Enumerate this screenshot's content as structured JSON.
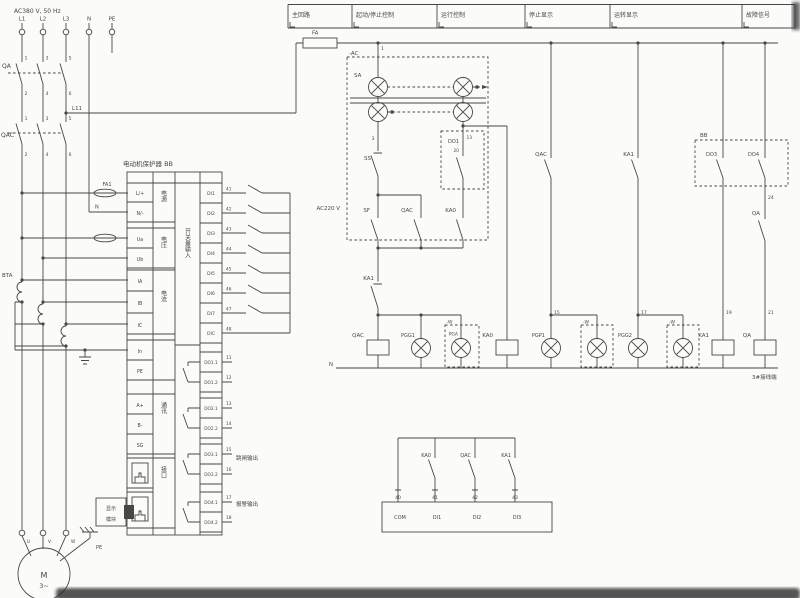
{
  "colors": {
    "ink": "#474747",
    "background": "#fbfbf9",
    "smear": "#2e2e2e"
  },
  "header": {
    "boxes": [
      {
        "label": "主回路"
      },
      {
        "label": "起动/停止控制"
      },
      {
        "label": "运行控制"
      },
      {
        "label": "停止显示"
      },
      {
        "label": "运转显示"
      },
      {
        "label": "故障信号"
      }
    ]
  },
  "block": {
    "title": "电动机保护器 BB"
  },
  "texts": [
    {
      "name": "supply-label",
      "t": "AC380 V, 50 Hz",
      "x": 14,
      "y": 13,
      "s": 6
    },
    {
      "name": "phase-l1-label",
      "t": "L1",
      "x": 22,
      "y": 20.5,
      "s": 5.5,
      "a": "m"
    },
    {
      "name": "phase-l2-label",
      "t": "L2",
      "x": 43,
      "y": 20.5,
      "s": 5.5,
      "a": "m"
    },
    {
      "name": "phase-l3-label",
      "t": "L3",
      "x": 66,
      "y": 20.5,
      "s": 5.5,
      "a": "m"
    },
    {
      "name": "neutral-label",
      "t": "N",
      "x": 89,
      "y": 20.5,
      "s": 5.5,
      "a": "m"
    },
    {
      "name": "pe-label",
      "t": "PE",
      "x": 112,
      "y": 20.5,
      "s": 5.5,
      "a": "m"
    },
    {
      "name": "breaker-label",
      "t": "QA",
      "x": 2,
      "y": 68,
      "s": 6
    },
    {
      "name": "qa-t1",
      "t": "1",
      "x": 26,
      "y": 59.5,
      "s": 4.5,
      "a": "m"
    },
    {
      "name": "qa-t3",
      "t": "3",
      "x": 47,
      "y": 59.5,
      "s": 4.5,
      "a": "m"
    },
    {
      "name": "qa-t5",
      "t": "5",
      "x": 70,
      "y": 59.5,
      "s": 4.5,
      "a": "m"
    },
    {
      "name": "qa-t2",
      "t": "2",
      "x": 26,
      "y": 95,
      "s": 4.5,
      "a": "m"
    },
    {
      "name": "qa-t4",
      "t": "4",
      "x": 47,
      "y": 95,
      "s": 4.5,
      "a": "m"
    },
    {
      "name": "qa-t6",
      "t": "6",
      "x": 70,
      "y": 95,
      "s": 4.5,
      "a": "m"
    },
    {
      "name": "contactor-label",
      "t": "QAC",
      "x": 1,
      "y": 137,
      "s": 6
    },
    {
      "name": "qac-t1",
      "t": "1",
      "x": 26,
      "y": 120,
      "s": 4.5,
      "a": "m"
    },
    {
      "name": "qac-t3",
      "t": "3",
      "x": 47,
      "y": 120,
      "s": 4.5,
      "a": "m"
    },
    {
      "name": "qac-t5",
      "t": "5",
      "x": 70,
      "y": 120,
      "s": 4.5,
      "a": "m"
    },
    {
      "name": "qac-t2",
      "t": "2",
      "x": 26,
      "y": 156,
      "s": 4.5,
      "a": "m"
    },
    {
      "name": "qac-t4",
      "t": "4",
      "x": 47,
      "y": 156,
      "s": 4.5,
      "a": "m"
    },
    {
      "name": "qac-t6",
      "t": "6",
      "x": 70,
      "y": 156,
      "s": 4.5,
      "a": "m"
    },
    {
      "name": "l11-label",
      "t": "L11",
      "x": 72,
      "y": 110,
      "s": 5.5
    },
    {
      "name": "fa-fuse-label",
      "t": "FA",
      "x": 312,
      "y": 34.5,
      "s": 5.5
    },
    {
      "name": "fa1-fuse-label",
      "t": "FA1",
      "x": 107,
      "y": 186,
      "s": 5,
      "a": "m"
    },
    {
      "name": "n-wire-label",
      "t": "N",
      "x": 95,
      "y": 208.5,
      "s": 5
    },
    {
      "name": "ct-label",
      "t": "BTA",
      "x": 2,
      "y": 277,
      "s": 5.5
    },
    {
      "name": "cell-l",
      "t": "L/+",
      "x": 140,
      "y": 195,
      "s": 4.8,
      "a": "m"
    },
    {
      "name": "cell-n",
      "t": "N/-",
      "x": 140,
      "y": 215,
      "s": 4.8,
      "a": "m"
    },
    {
      "name": "cell-ua",
      "t": "Ua",
      "x": 140,
      "y": 241,
      "s": 4.8,
      "a": "m"
    },
    {
      "name": "cell-ub",
      "t": "Ub",
      "x": 140,
      "y": 261,
      "s": 4.8,
      "a": "m"
    },
    {
      "name": "cell-ia",
      "t": "IA",
      "x": 140,
      "y": 283,
      "s": 4.8,
      "a": "m"
    },
    {
      "name": "cell-ib",
      "t": "IB",
      "x": 140,
      "y": 305,
      "s": 4.8,
      "a": "m"
    },
    {
      "name": "cell-ic",
      "t": "IC",
      "x": 140,
      "y": 327,
      "s": 4.8,
      "a": "m"
    },
    {
      "name": "cell-in",
      "t": "In",
      "x": 140,
      "y": 353,
      "s": 4.8,
      "a": "m"
    },
    {
      "name": "cell-pe",
      "t": "PE",
      "x": 140,
      "y": 373,
      "s": 4.8,
      "a": "m"
    },
    {
      "name": "cell-aplus",
      "t": "A+",
      "x": 140,
      "y": 407,
      "s": 4.8,
      "a": "m"
    },
    {
      "name": "cell-bminus",
      "t": "B-",
      "x": 140,
      "y": 427,
      "s": 4.8,
      "a": "m"
    },
    {
      "name": "cell-sg",
      "t": "SG",
      "x": 140,
      "y": 447,
      "s": 4.8,
      "a": "m"
    },
    {
      "name": "group-power",
      "t": "电源",
      "x": 163,
      "y": 190,
      "s": 6,
      "v": 1
    },
    {
      "name": "group-voltage",
      "t": "电压",
      "x": 163,
      "y": 236,
      "s": 6,
      "v": 1
    },
    {
      "name": "group-current",
      "t": "电流",
      "x": 163,
      "y": 290,
      "s": 6,
      "v": 1
    },
    {
      "name": "group-comm",
      "t": "通讯",
      "x": 163,
      "y": 402,
      "s": 6,
      "v": 1
    },
    {
      "name": "group-port",
      "t": "接口",
      "x": 163,
      "y": 466,
      "s": 6,
      "v": 1
    },
    {
      "name": "group-di",
      "t": "开关量输入",
      "x": 187,
      "y": 228,
      "s": 6,
      "v": 1
    },
    {
      "name": "cell-di1",
      "t": "DI1",
      "x": 211,
      "y": 195,
      "s": 4.6,
      "a": "m"
    },
    {
      "name": "cell-di2",
      "t": "DI2",
      "x": 211,
      "y": 215,
      "s": 4.6,
      "a": "m"
    },
    {
      "name": "cell-di3",
      "t": "DI3",
      "x": 211,
      "y": 235,
      "s": 4.6,
      "a": "m"
    },
    {
      "name": "cell-di4",
      "t": "DI4",
      "x": 211,
      "y": 255,
      "s": 4.6,
      "a": "m"
    },
    {
      "name": "cell-di5",
      "t": "DI5",
      "x": 211,
      "y": 275,
      "s": 4.6,
      "a": "m"
    },
    {
      "name": "cell-di6",
      "t": "DI6",
      "x": 211,
      "y": 295,
      "s": 4.6,
      "a": "m"
    },
    {
      "name": "cell-di7",
      "t": "DI7",
      "x": 211,
      "y": 315,
      "s": 4.6,
      "a": "m"
    },
    {
      "name": "cell-dic",
      "t": "DIC",
      "x": 211,
      "y": 335,
      "s": 4.6,
      "a": "m"
    },
    {
      "name": "di-t41",
      "t": "41",
      "x": 226,
      "y": 190.5,
      "s": 4.3
    },
    {
      "name": "di-t42",
      "t": "42",
      "x": 226,
      "y": 210.5,
      "s": 4.3
    },
    {
      "name": "di-t43",
      "t": "43",
      "x": 226,
      "y": 230.5,
      "s": 4.3
    },
    {
      "name": "di-t44",
      "t": "44",
      "x": 226,
      "y": 250.5,
      "s": 4.3
    },
    {
      "name": "di-t45",
      "t": "45",
      "x": 226,
      "y": 270.5,
      "s": 4.3
    },
    {
      "name": "di-t46",
      "t": "46",
      "x": 226,
      "y": 290.5,
      "s": 4.3
    },
    {
      "name": "di-t47",
      "t": "47",
      "x": 226,
      "y": 310.5,
      "s": 4.3
    },
    {
      "name": "di-t48",
      "t": "48",
      "x": 226,
      "y": 330.5,
      "s": 4.3
    },
    {
      "name": "cell-do11",
      "t": "DO1.1",
      "x": 211,
      "y": 364,
      "s": 4.3,
      "a": "m"
    },
    {
      "name": "cell-do12",
      "t": "DO1.2",
      "x": 211,
      "y": 384,
      "s": 4.3,
      "a": "m"
    },
    {
      "name": "cell-do21",
      "t": "DO2.1",
      "x": 211,
      "y": 410,
      "s": 4.3,
      "a": "m"
    },
    {
      "name": "cell-do22",
      "t": "DO2.2",
      "x": 211,
      "y": 430,
      "s": 4.3,
      "a": "m"
    },
    {
      "name": "cell-do31",
      "t": "DO3.1",
      "x": 211,
      "y": 456,
      "s": 4.3,
      "a": "m"
    },
    {
      "name": "cell-do32",
      "t": "DO3.2",
      "x": 211,
      "y": 476,
      "s": 4.3,
      "a": "m"
    },
    {
      "name": "cell-do41",
      "t": "DO4.1",
      "x": 211,
      "y": 504,
      "s": 4.3,
      "a": "m"
    },
    {
      "name": "cell-do42",
      "t": "DO4.2",
      "x": 211,
      "y": 524,
      "s": 4.3,
      "a": "m"
    },
    {
      "name": "do-t11",
      "t": "11",
      "x": 226,
      "y": 359,
      "s": 4.3
    },
    {
      "name": "do-t12",
      "t": "12",
      "x": 226,
      "y": 379,
      "s": 4.3
    },
    {
      "name": "do-t13",
      "t": "13",
      "x": 226,
      "y": 405,
      "s": 4.3
    },
    {
      "name": "do-t14",
      "t": "14",
      "x": 226,
      "y": 425,
      "s": 4.3
    },
    {
      "name": "do-t15",
      "t": "15",
      "x": 226,
      "y": 451,
      "s": 4.3
    },
    {
      "name": "do-t16",
      "t": "16",
      "x": 226,
      "y": 471,
      "s": 4.3
    },
    {
      "name": "do-t17",
      "t": "17",
      "x": 226,
      "y": 499,
      "s": 4.3
    },
    {
      "name": "do-t18",
      "t": "18",
      "x": 226,
      "y": 519,
      "s": 4.3
    },
    {
      "name": "trip-output-label",
      "t": "跳闸输出",
      "x": 236,
      "y": 460,
      "s": 5.5
    },
    {
      "name": "alarm-output-label",
      "t": "报警输出",
      "x": 236,
      "y": 506,
      "s": 5.5
    },
    {
      "name": "module-line1",
      "t": "显示",
      "x": 111,
      "y": 510,
      "s": 5,
      "a": "m"
    },
    {
      "name": "module-line2",
      "t": "模块",
      "x": 111,
      "y": 521,
      "s": 5,
      "a": "m"
    },
    {
      "name": "ac-box-label",
      "t": "-AC",
      "x": 349,
      "y": 55,
      "s": 5.5
    },
    {
      "name": "term-1",
      "t": "1",
      "x": 381,
      "y": 50,
      "s": 4.5
    },
    {
      "name": "selector-label",
      "t": "SA",
      "x": 354,
      "y": 77,
      "s": 5.5
    },
    {
      "name": "ac220-label",
      "t": "AC220 V",
      "x": 340,
      "y": 210,
      "s": 5.5,
      "a": "e"
    },
    {
      "name": "term-3",
      "t": "3",
      "x": 374.5,
      "y": 140,
      "s": 4.5,
      "a": "e"
    },
    {
      "name": "stop-button-label",
      "t": "SS",
      "x": 371,
      "y": 160,
      "s": 5.5,
      "a": "e"
    },
    {
      "name": "start-button-label",
      "t": "SF",
      "x": 370,
      "y": 212,
      "s": 5.5,
      "a": "e"
    },
    {
      "name": "qac-aux-label",
      "t": "QAC",
      "x": 413,
      "y": 212,
      "s": 5.5,
      "a": "e"
    },
    {
      "name": "ka0-aux-label",
      "t": "KA0",
      "x": 456,
      "y": 212,
      "s": 5.5,
      "a": "e"
    },
    {
      "name": "do1-contact-label",
      "t": "DO1",
      "x": 459,
      "y": 143,
      "s": 5,
      "a": "e"
    },
    {
      "name": "do1-term",
      "t": "20",
      "x": 459,
      "y": 152,
      "s": 4.3,
      "a": "e"
    },
    {
      "name": "term-13",
      "t": "13",
      "x": 466.5,
      "y": 139,
      "s": 4.3
    },
    {
      "name": "ka1-nc-label",
      "t": "KA1",
      "x": 374,
      "y": 280,
      "s": 5.5,
      "a": "e"
    },
    {
      "name": "qac-coil-label",
      "t": "QAC",
      "x": 364,
      "y": 337,
      "s": 5.5,
      "a": "e"
    },
    {
      "name": "pgg1-lamp-label",
      "t": "PGG1",
      "x": 415,
      "y": 337,
      "s": 5,
      "a": "e"
    },
    {
      "name": "w1-label",
      "t": "-W",
      "x": 446.5,
      "y": 323.5,
      "s": 4.5
    },
    {
      "name": "pga-lamp-label",
      "t": "PGA",
      "x": 458,
      "y": 335.5,
      "s": 4.5,
      "a": "e"
    },
    {
      "name": "ka0-coil-label",
      "t": "KA0",
      "x": 493,
      "y": 337,
      "s": 5.5,
      "a": "e"
    },
    {
      "name": "pgp1-lamp-label",
      "t": "PGP1",
      "x": 545,
      "y": 337,
      "s": 5,
      "a": "e"
    },
    {
      "name": "w2-label",
      "t": "-W",
      "x": 583,
      "y": 323.5,
      "s": 4.5
    },
    {
      "name": "pgg2-lamp-label",
      "t": "PGG2",
      "x": 632,
      "y": 337,
      "s": 5,
      "a": "e"
    },
    {
      "name": "w3-label",
      "t": "-W",
      "x": 669,
      "y": 323.5,
      "s": 4.5
    },
    {
      "name": "ka1-coil-label",
      "t": "KA1",
      "x": 709,
      "y": 337,
      "s": 5.5,
      "a": "e"
    },
    {
      "name": "qa-coil-label",
      "t": "QA",
      "x": 751,
      "y": 337,
      "s": 5.5,
      "a": "e"
    },
    {
      "name": "qac-display-contact-label",
      "t": "QAC",
      "x": 547,
      "y": 156,
      "s": 5.5,
      "a": "e"
    },
    {
      "name": "ka1-display-contact-label",
      "t": "KA1",
      "x": 634,
      "y": 156,
      "s": 5.5,
      "a": "e"
    },
    {
      "name": "bb-box-label",
      "t": "BB",
      "x": 700,
      "y": 137,
      "s": 5.5
    },
    {
      "name": "do3-contact-label",
      "t": "DO3",
      "x": 717,
      "y": 156,
      "s": 5,
      "a": "e"
    },
    {
      "name": "do4-contact-label",
      "t": "DO4",
      "x": 759,
      "y": 156,
      "s": 5,
      "a": "e"
    },
    {
      "name": "term-24",
      "t": "24",
      "x": 768,
      "y": 199,
      "s": 4.5
    },
    {
      "name": "qa-contact-label",
      "t": "QA",
      "x": 760,
      "y": 215,
      "s": 5.5,
      "a": "e"
    },
    {
      "name": "term-15",
      "t": "15",
      "x": 554,
      "y": 314,
      "s": 4.5
    },
    {
      "name": "term-17",
      "t": "17",
      "x": 641,
      "y": 314,
      "s": 4.5
    },
    {
      "name": "term-19",
      "t": "19",
      "x": 726,
      "y": 314,
      "s": 4.5
    },
    {
      "name": "term-21",
      "t": "21",
      "x": 768,
      "y": 314,
      "s": 4.5
    },
    {
      "name": "rail-n-label",
      "t": "N",
      "x": 333,
      "y": 366,
      "s": 5.5,
      "a": "e"
    },
    {
      "name": "junction-box-label",
      "t": "3#接线端",
      "x": 752,
      "y": 379,
      "s": 5.5
    },
    {
      "name": "fb-ka0-label",
      "t": "KA0",
      "x": 431,
      "y": 457,
      "s": 5,
      "a": "e"
    },
    {
      "name": "fb-qac-label",
      "t": "QAC",
      "x": 471,
      "y": 457,
      "s": 5,
      "a": "e"
    },
    {
      "name": "fb-ka1-label",
      "t": "KA1",
      "x": 511,
      "y": 457,
      "s": 5,
      "a": "e"
    },
    {
      "name": "fb-t40",
      "t": "40",
      "x": 398,
      "y": 499,
      "s": 4.5,
      "a": "m"
    },
    {
      "name": "fb-t41",
      "t": "41",
      "x": 435,
      "y": 499,
      "s": 4.5,
      "a": "m"
    },
    {
      "name": "fb-t42",
      "t": "42",
      "x": 475,
      "y": 499,
      "s": 4.5,
      "a": "m"
    },
    {
      "name": "fb-t43",
      "t": "43",
      "x": 515,
      "y": 499,
      "s": 4.5,
      "a": "m"
    },
    {
      "name": "fb-com",
      "t": "COM",
      "x": 400,
      "y": 519,
      "s": 5,
      "a": "m"
    },
    {
      "name": "fb-di1",
      "t": "DI1",
      "x": 437,
      "y": 519,
      "s": 5,
      "a": "m"
    },
    {
      "name": "fb-di2",
      "t": "DI2",
      "x": 477,
      "y": 519,
      "s": 5,
      "a": "m"
    },
    {
      "name": "fb-di3",
      "t": "DI3",
      "x": 517,
      "y": 519,
      "s": 5,
      "a": "m"
    },
    {
      "name": "motor-m",
      "t": "M",
      "x": 44,
      "y": 578,
      "s": 8,
      "a": "m"
    },
    {
      "name": "motor-3ph",
      "t": "3~",
      "x": 44,
      "y": 588,
      "s": 6.5,
      "a": "m"
    },
    {
      "name": "motor-u",
      "t": "U",
      "x": 27,
      "y": 543,
      "s": 4.3
    },
    {
      "name": "motor-v",
      "t": "V",
      "x": 48,
      "y": 543,
      "s": 4.3
    },
    {
      "name": "motor-w",
      "t": "W",
      "x": 71,
      "y": 543,
      "s": 4.3
    },
    {
      "name": "motor-pe-label",
      "t": "PE",
      "x": 96,
      "y": 549,
      "s": 5
    }
  ]
}
